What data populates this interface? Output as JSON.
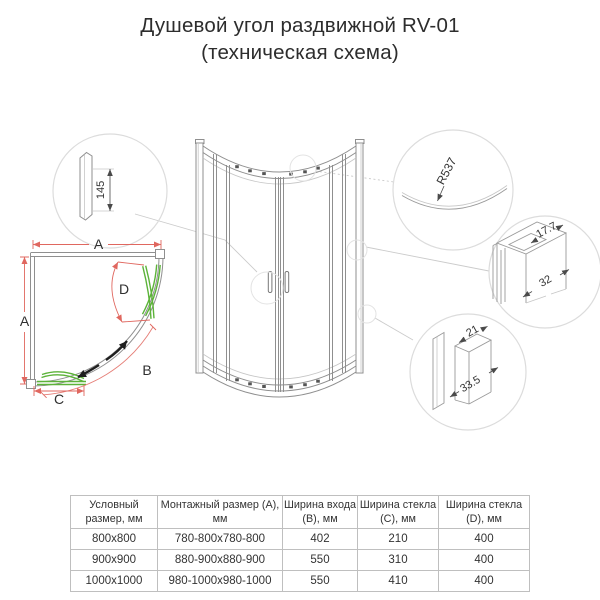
{
  "title": {
    "line1": "Душевой угол раздвижной RV-01",
    "line2": "(техническая схема)"
  },
  "diagram": {
    "labels": {
      "install_width": "A",
      "install_depth": "A",
      "entry_width": "B",
      "glass_c": "C",
      "glass_d": "D",
      "profile_height": "145",
      "door_radius": "R537",
      "top_profile_width": "17.7",
      "top_profile_depth": "32",
      "wall_profile_width": "21",
      "wall_profile_depth": "33.5"
    },
    "colors": {
      "glass": "#5cb339",
      "dimension": "#e0675f",
      "line": "#8f8f8f",
      "leader": "#cbcbcb",
      "detail_circle": "#dcdcdc",
      "arrow": "#1f1f1f",
      "table_border": "#bfbfbf",
      "text": "#333333"
    }
  },
  "table": {
    "headers": [
      "Условный размер, мм",
      "Монтажный размер (A), мм",
      "Ширина входа (B), мм",
      "Ширина стекла (C), мм",
      "Ширина стекла (D), мм"
    ],
    "rows": [
      [
        "800x800",
        "780-800x780-800",
        "402",
        "210",
        "400"
      ],
      [
        "900x900",
        "880-900x880-900",
        "550",
        "310",
        "400"
      ],
      [
        "1000x1000",
        "980-1000x980-1000",
        "550",
        "410",
        "400"
      ]
    ]
  }
}
